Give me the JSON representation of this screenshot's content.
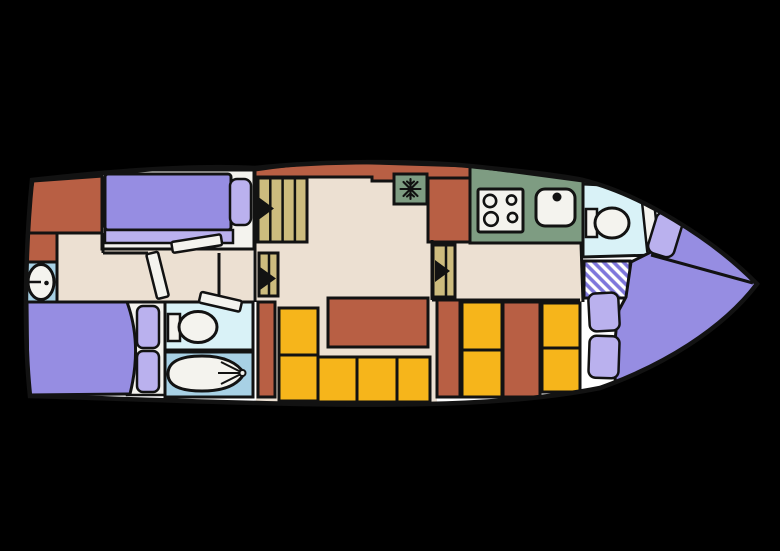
{
  "palette": {
    "background": "#000000",
    "hull_interior": "#ffffff",
    "outline": "#121212",
    "floor_beige": "#ece0d2",
    "cabinet_sienna": "#b85f44",
    "mattress_purple": "#968de2",
    "pillow_lilac": "#bab1ee",
    "sofa_yellow": "#f6b51b",
    "galley_green": "#7e9c82",
    "wc_floor_cyan": "#d9f2f7",
    "bath_floor_blue": "#a8d1e5",
    "stairs_tan": "#cdbc7e",
    "hatch_stripe": "#7e76db",
    "fixture_white": "#f4f3ee",
    "icon_black": "#111111"
  },
  "icons": {
    "freezer_icon": "❄",
    "stair_direction_icon": "▶"
  }
}
